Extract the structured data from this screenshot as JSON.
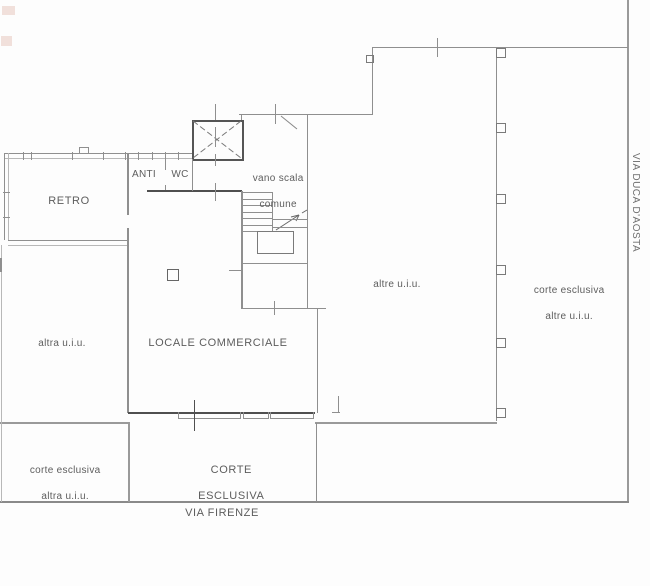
{
  "plan": {
    "rooms": {
      "retro": "RETRO",
      "anti": "ANTI",
      "wc": "WC",
      "vano_scala_line1": "vano scala",
      "vano_scala_line2": "comune",
      "locale_commerciale": "LOCALE COMMERCIALE",
      "altra_uiu": "altra u.i.u.",
      "altre_uiu": "altre u.i.u.",
      "corte_esclusiva_altre_line1": "corte esclusiva",
      "corte_esclusiva_altre_line2": "altre u.i.u.",
      "corte_esclusiva_altra_line1": "corte esclusiva",
      "corte_esclusiva_altra_line2": "altra u.i.u.",
      "corte_esclusiva_line1": "CORTE",
      "corte_esclusiva_line2": "ESCLUSIVA"
    },
    "streets": {
      "bottom": "VIA FIRENZE",
      "right": "VIA DUCA D'AOSTA"
    },
    "colors": {
      "background": "#fdfdfd",
      "wall_thin": "#8f8f8f",
      "wall_dark": "#4f4f4f",
      "text": "#5d5d5d",
      "corner_mark": "#c77a66"
    }
  }
}
